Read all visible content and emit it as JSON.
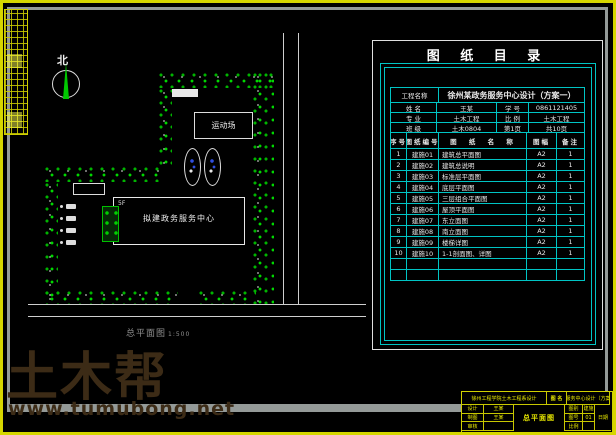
{
  "watermark": {
    "title": "土木帮",
    "url": "www.tumubong.net"
  },
  "colors": {
    "frame_yellow": "#d6d600",
    "frame_gray": "#949a98",
    "table_cyan": "#00c4c4",
    "tree_green": "#00c000",
    "watermark_brown": "#3c2b16",
    "line_white": "#e8e8e8"
  },
  "site_plan": {
    "north_label": "北",
    "sports_field_label": "运动场",
    "building_label": "拟建政务服务中心",
    "building_floors": "5F",
    "caption": "总平面图",
    "caption_scale": "1:500"
  },
  "catalog": {
    "title": "图 纸 目 录",
    "project_label": "工程名称",
    "project_value": "徐州某政务服务中心设计（方案一）",
    "info_rows": [
      {
        "l1": "姓 名",
        "v1": "王某",
        "l2": "学 号",
        "v2": "0861121405"
      },
      {
        "l1": "专 业",
        "v1": "土木工程",
        "l2": "比 例",
        "v2": "土木工程"
      },
      {
        "l1": "班 级",
        "v1": "土木0804",
        "l2": "第1页",
        "v2": "共10页"
      }
    ],
    "columns": [
      "序号",
      "图纸编号",
      "图 纸 名 称",
      "图幅",
      "备注"
    ],
    "rows": [
      [
        "1",
        "建施01",
        "建筑总平面图",
        "A2",
        "1"
      ],
      [
        "2",
        "建施02",
        "建筑总说明",
        "A2",
        "1"
      ],
      [
        "3",
        "建施03",
        "标准层平面图",
        "A2",
        "1"
      ],
      [
        "4",
        "建施04",
        "底层平面图",
        "A2",
        "1"
      ],
      [
        "5",
        "建施05",
        "三层组合平面图",
        "A2",
        "1"
      ],
      [
        "6",
        "建施06",
        "屋顶平面图",
        "A2",
        "1"
      ],
      [
        "7",
        "建施07",
        "东立面图",
        "A2",
        "1"
      ],
      [
        "8",
        "建施08",
        "南立面图",
        "A2",
        "1"
      ],
      [
        "9",
        "建施09",
        "楼梯详图",
        "A2",
        "1"
      ],
      [
        "10",
        "建施10",
        "1-1剖面图、详图",
        "A2",
        "1"
      ]
    ],
    "empty_row_count": 2
  },
  "title_block": {
    "top_left": "徐州工程学院土木工程系设计",
    "name_label": "图 名",
    "top_right": "政务服务中心设计（方案一）",
    "drawing_name": "总平面图",
    "left_rows": [
      {
        "label": "设计",
        "value": "王某"
      },
      {
        "label": "制图",
        "value": "王某"
      },
      {
        "label": "审核",
        "value": ""
      }
    ],
    "right_rows": [
      {
        "label": "图别",
        "value": "建施"
      },
      {
        "label": "图号",
        "value": "01"
      },
      {
        "label": "比例",
        "value": ""
      }
    ],
    "tall_cell": "日期"
  }
}
